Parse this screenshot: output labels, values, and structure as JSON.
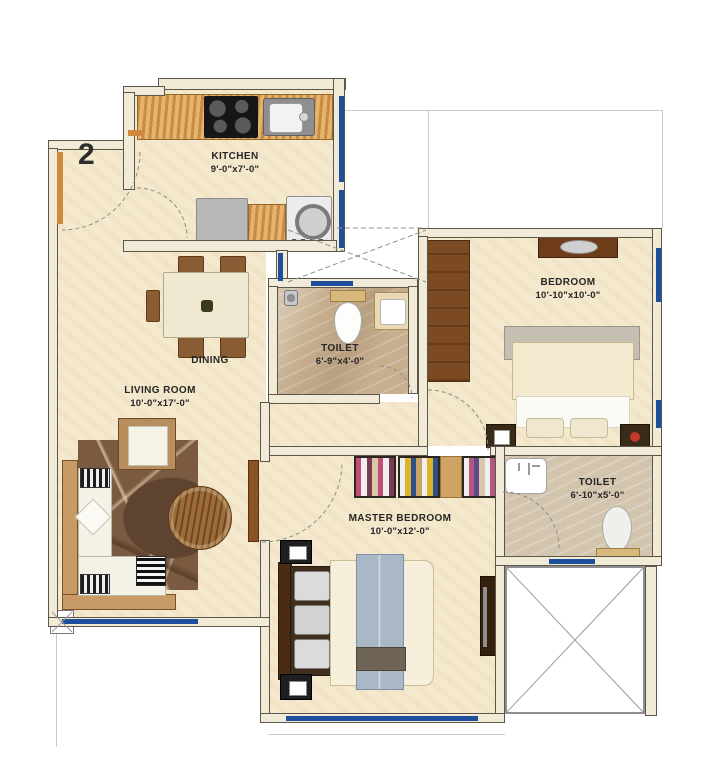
{
  "floorplan": {
    "unit_number": "2",
    "rooms": {
      "kitchen": {
        "name": "KITCHEN",
        "dims": "9'-0\"x7'-0\""
      },
      "dining": {
        "name": "DINING",
        "dims": ""
      },
      "living_room": {
        "name": "LIVING ROOM",
        "dims": "10'-0\"x17'-0\""
      },
      "toilet_1": {
        "name": "TOILET",
        "dims": "6'-9\"x4'-0\""
      },
      "bedroom": {
        "name": "BEDROOM",
        "dims": "10'-10\"x10'-0\""
      },
      "toilet_2": {
        "name": "TOILET",
        "dims": "6'-10\"x5'-0\""
      },
      "master_bedroom": {
        "name": "MASTER BEDROOM",
        "dims": "10'-0\"x12'-0\""
      }
    },
    "colors": {
      "window_blue": "#1d4f9c",
      "wall_fill": "#f1ead6",
      "floor_cream": "#f4e8cd",
      "toilet_floor_marble": "#c6ae8e",
      "toilet2_floor": "#d2c4ad",
      "counter_wood": "#dfa45a",
      "furniture_brown": "#8a5c33",
      "door_orange": "#d08a3e",
      "bed_blanket_blue": "#a9b7c7"
    }
  }
}
